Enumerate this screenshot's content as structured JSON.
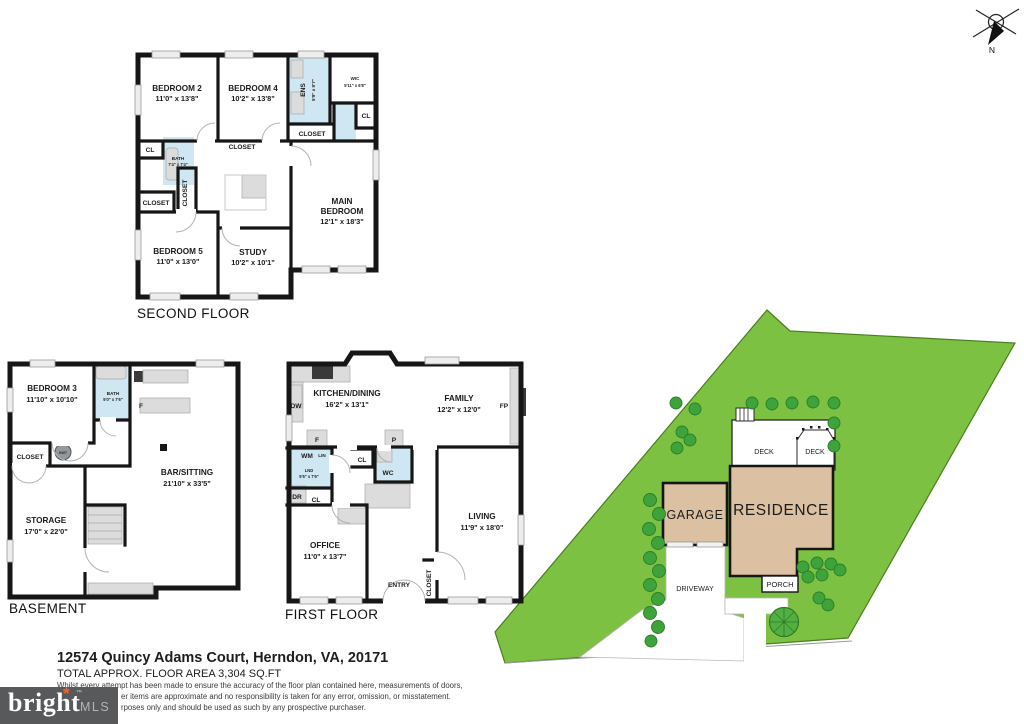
{
  "compass": {
    "north_label": "N"
  },
  "second_floor": {
    "title": "SECOND FLOOR",
    "bedroom2": {
      "name": "BEDROOM 2",
      "dims": "11'0\" x 13'8\""
    },
    "bedroom4": {
      "name": "BEDROOM 4",
      "dims": "10'2\" x 13'8\""
    },
    "ens": {
      "name": "ENS",
      "dims": "5'9\" x 9'7\""
    },
    "wic": {
      "name": "WIC",
      "dims": "5'11\" x 6'8\""
    },
    "cl_top_left": "CL",
    "cl_right": "CL",
    "bath": {
      "name": "BATH",
      "dims": "7'4\" x 7'4\""
    },
    "closet_bed4": "CLOSET",
    "closet_main": "CLOSET",
    "closet_hall": "CLOSET",
    "closet_bed5": "CLOSET",
    "bedroom5": {
      "name": "BEDROOM 5",
      "dims": "11'0\" x 13'0\""
    },
    "study": {
      "name": "STUDY",
      "dims": "10'2\" x 10'1\""
    },
    "main_bedroom": {
      "line1": "MAIN",
      "line2": "BEDROOM",
      "dims": "12'1\" x 18'3\""
    }
  },
  "first_floor": {
    "title": "FIRST FLOOR",
    "kitchen": {
      "name": "KITCHEN/DINING",
      "dims": "16'2\" x 13'1\""
    },
    "family": {
      "name": "FAMILY",
      "dims": "12'2\" x 12'0\""
    },
    "fp": "FP",
    "dw": "DW",
    "f": "F",
    "p": "P",
    "wm": "WM",
    "lin": "LIN",
    "lnd": {
      "name": "LND",
      "dims": "5'5\" x 7'6\""
    },
    "dr": "DR",
    "cl_laundry": "CL",
    "cl_hall": "CL",
    "wc": "WC",
    "office": {
      "name": "OFFICE",
      "dims": "11'0\" x 13'7\""
    },
    "living": {
      "name": "LIVING",
      "dims": "11'9\" x 18'0\""
    },
    "entry": "ENTRY",
    "closet_entry": "CLOSET"
  },
  "basement": {
    "title": "BASEMENT",
    "bedroom3": {
      "name": "BEDROOM 3",
      "dims": "11'10\" x 10'10\""
    },
    "bath": {
      "name": "BATH",
      "dims": "5'0\" x 7'6\""
    },
    "f": "F",
    "closet": "CLOSET",
    "hwt": "HWT",
    "bar": {
      "name": "BAR/SITTING",
      "dims": "21'10\" x 33'5\""
    },
    "storage": {
      "name": "STORAGE",
      "dims": "17'0\" x 22'0\""
    }
  },
  "site": {
    "garage": "GARAGE",
    "residence": "RESIDENCE",
    "deck_left": "DECK",
    "deck_right": "DECK",
    "porch": "PORCH",
    "driveway": "DRIVEWAY"
  },
  "footer": {
    "address": "12574 Quincy Adams Court, Herndon, VA, 20171",
    "area": "TOTAL APPROX. FLOOR AREA 3,304 SQ.FT",
    "disclaimer_line1": "Whilst every attempt has been made to ensure the accuracy of the floor plan contained here, measurements of doors,",
    "disclaimer_line2": "er items are approximate and no responsibility is taken for any error, omission, or misstatement.",
    "disclaimer_line3": "rposes only and should be used as such by any prospective purchaser."
  },
  "logo": {
    "brand": "bright",
    "tm": "™",
    "suffix": "MLS"
  },
  "colors": {
    "lot_green": "#7dc142",
    "building_tan": "#dcc0a2",
    "bath_blue": "#cfe7f2",
    "wall_black": "#161616",
    "logo_bg": "#58595b",
    "logo_star": "#f26631"
  }
}
